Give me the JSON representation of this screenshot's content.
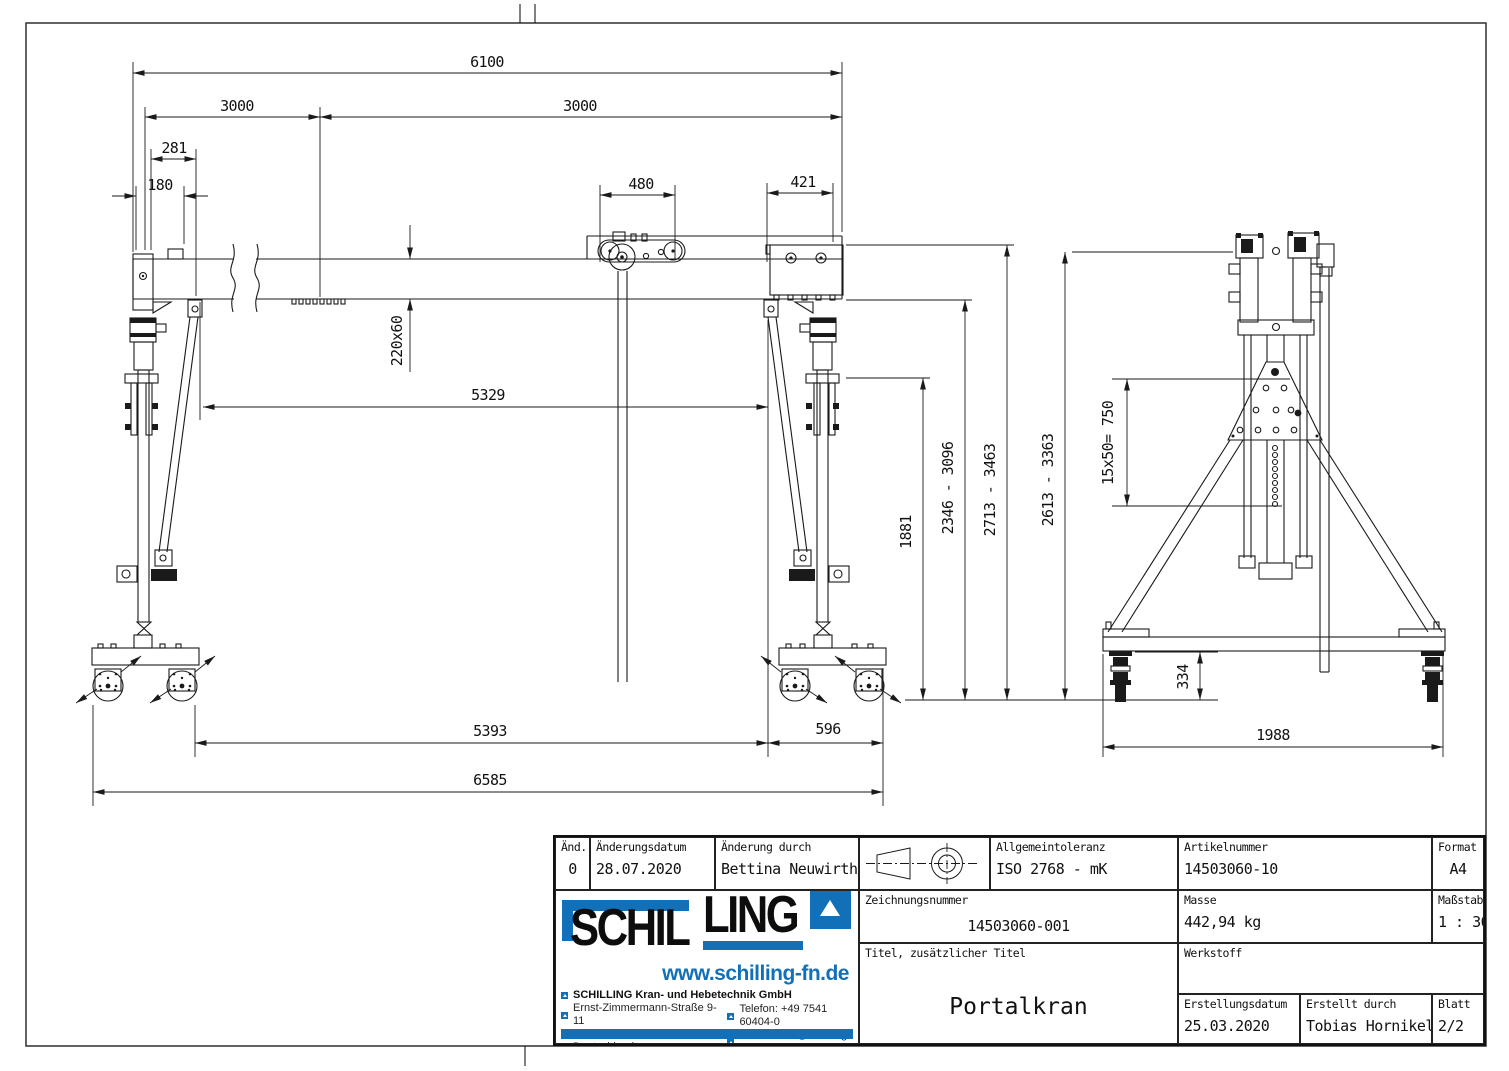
{
  "drawing": {
    "title": "Portalkran",
    "dims": {
      "overall_width": "6100",
      "span_left": "3000",
      "span_right": "3000",
      "leg_offset": "281",
      "end_offset": "180",
      "trolley_width": "480",
      "bracket_width": "421",
      "beam_profile": "220x60",
      "hook_travel": "5329",
      "leg_height": "1881",
      "lift_range_inner": "2346 - 3096",
      "lift_range_outer": "2713 - 3463",
      "base_span": "5393",
      "caster_span": "596",
      "overall_length": "6585",
      "side_height_range": "2613 - 3363",
      "hole_pattern": "15x50= 750",
      "caster_height": "334",
      "side_base_width": "1988"
    }
  },
  "titleblock": {
    "rev": {
      "label": "Änd.",
      "value": "0"
    },
    "rev_date": {
      "label": "Änderungsdatum",
      "value": "28.07.2020"
    },
    "rev_by": {
      "label": "Änderung durch",
      "value": "Bettina Neuwirth"
    },
    "tolerance": {
      "label": "Allgemeintoleranz",
      "value": "ISO 2768 - mK"
    },
    "article_no": {
      "label": "Artikelnummer",
      "value": "14503060-10"
    },
    "format": {
      "label": "Format",
      "value": "A4"
    },
    "drawing_no": {
      "label": "Zeichnungsnummer",
      "value": "14503060-001"
    },
    "mass": {
      "label": "Masse",
      "value": "442,94 kg"
    },
    "scale": {
      "label": "Maßstab",
      "value": "1 : 30"
    },
    "title": {
      "label": "Titel, zusätzlicher Titel",
      "value": "Portalkran"
    },
    "material": {
      "label": "Werkstoff",
      "value": ""
    },
    "created_date": {
      "label": "Erstellungsdatum",
      "value": "25.03.2020"
    },
    "created_by": {
      "label": "Erstellt durch",
      "value": "Tobias Hornikel"
    },
    "sheet": {
      "label": "Blatt",
      "value": "2/2"
    }
  },
  "company": {
    "logo_part1": "SCHIL",
    "logo_part2": "LING",
    "website": "www.schilling-fn.de",
    "name": "SCHILLING Kran- und Hebetechnik GmbH",
    "street": "Ernst-Zimmermann-Straße 9-11",
    "city": "88045 Friedrichshafen",
    "country": "Deutschland",
    "phone": "Telefon: +49 7541 60404-0",
    "email": "E-Mail: mail@schilling-fn.de"
  },
  "icons": {
    "projection": "first-angle-projection-symbol",
    "logo_triangle": "triangle-icon"
  },
  "colors": {
    "brand_blue": "#1170b8",
    "line": "#1a1a1a",
    "paper": "#ffffff"
  }
}
